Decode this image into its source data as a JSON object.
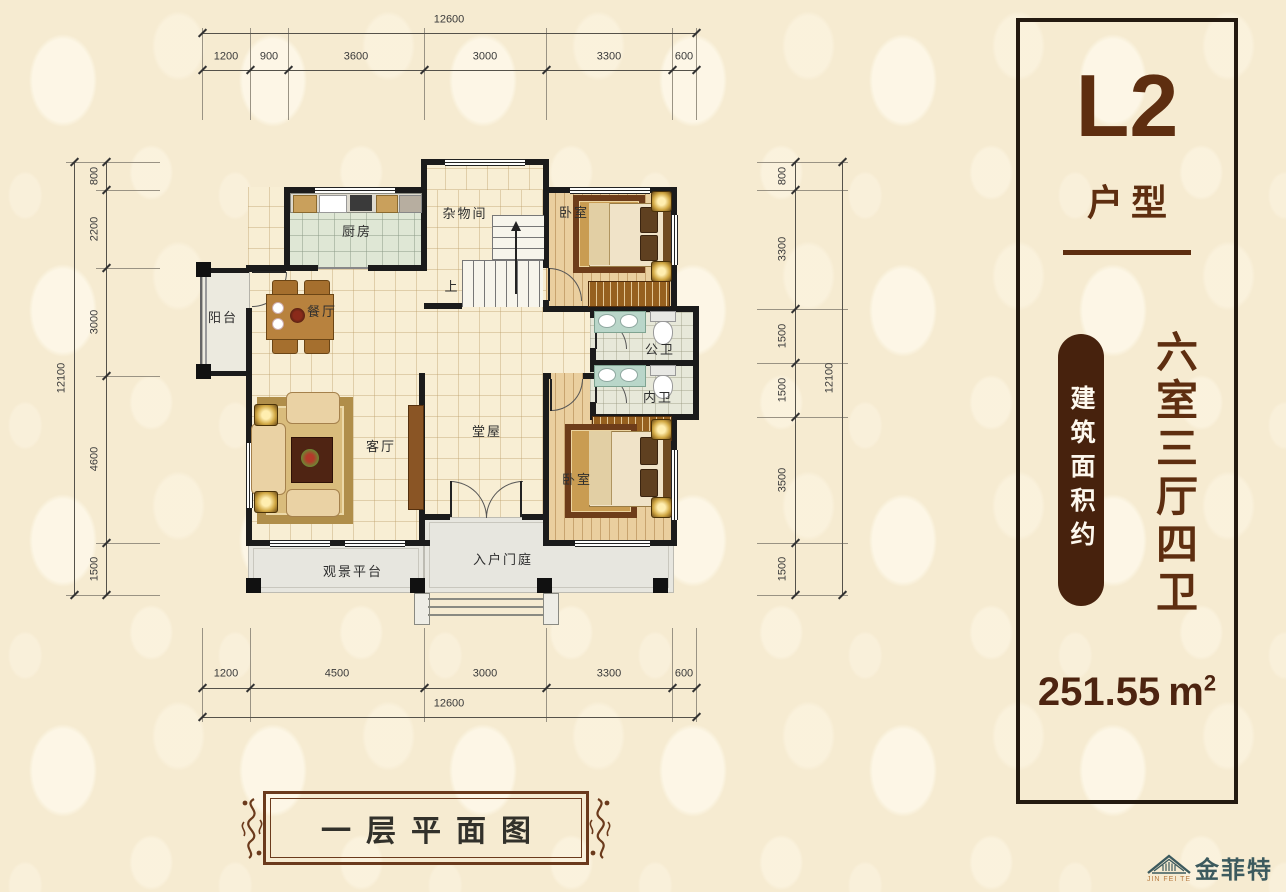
{
  "panel": {
    "unit_code": "L2",
    "unit_type_label": "户型",
    "area_prefix": "建筑面积约",
    "layout_desc": "六室三厅四卫",
    "area_value": "251.55",
    "area_unit": "m",
    "area_sup": "2"
  },
  "title": {
    "text": "一层平面图"
  },
  "logo": {
    "name": "金菲特",
    "sub": "JIN FEI TE"
  },
  "dims": {
    "top": {
      "total": "12600",
      "segments": [
        "1200",
        "900",
        "3600",
        "3000",
        "3300",
        "600"
      ]
    },
    "bottom": {
      "total": "12600",
      "segments": [
        "1200",
        "4500",
        "3000",
        "3300",
        "600"
      ]
    },
    "left": {
      "total": "12100",
      "segments": [
        "800",
        "2200",
        "3000",
        "4600",
        "1500"
      ]
    },
    "right": {
      "total": "12100",
      "segments": [
        "800",
        "3300",
        "1500",
        "1500",
        "3500",
        "1500"
      ]
    }
  },
  "rooms": {
    "kitchen": "厨房",
    "storage": "杂物间",
    "bedroom_top": "卧室",
    "bedroom_bottom": "卧室",
    "dining": "餐厅",
    "balcony": "阳台",
    "bath_public": "公卫",
    "bath_private": "内卫",
    "living": "客厅",
    "hall": "堂屋",
    "platform": "观景平台",
    "entrance": "入户门庭",
    "stairs_up": "上"
  },
  "colors": {
    "accent_brown": "#5e2e10",
    "pill_brown": "#47220d",
    "wall_black": "#1b1b1b",
    "logo_teal": "#3c5a5e",
    "background_cream": "#f6ebd1"
  }
}
